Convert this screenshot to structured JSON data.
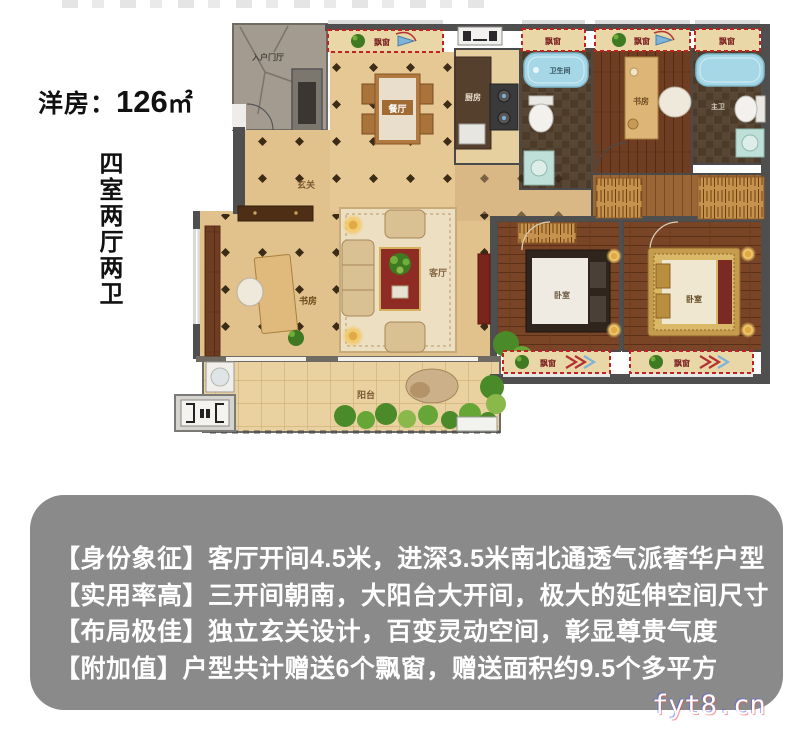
{
  "page": {
    "background": "#ffffff"
  },
  "header": {
    "title_prefix": "洋房：",
    "title_area": "126",
    "title_unit": "㎡",
    "vertical_label": "四室两厅两卫"
  },
  "floorplan": {
    "labels": {
      "entry_hall": "入户门厅",
      "foyer": "玄关",
      "dining": "餐厅",
      "kitchen": "厨房",
      "bath_main": "卫生间",
      "bath_master": "主卫",
      "study_top": "书房",
      "study_left": "书房",
      "living": "客厅",
      "bedroom_1": "卧室",
      "bedroom_2": "卧室",
      "balcony": "阳台",
      "bay_window": "飘窗"
    },
    "colors": {
      "wall": "#4f4f4f",
      "floor_beige": "#e2c28c",
      "wood_dark": "#7a4527",
      "bay_window_border": "#c32222",
      "bathtub_blue": "#a6d7e6",
      "stone_gray": "#a39b90"
    }
  },
  "features": {
    "panel_color": "#8a8a8a",
    "lines": [
      "【身份象征】客厅开间4.5米，进深3.5米南北通透气派奢华户型",
      "【实用率高】三开间朝南，大阳台大开间，极大的延伸空间尺寸",
      "【布局极佳】独立玄关设计，百变灵动空间，彰显尊贵气度",
      "【附加值】户型共计赠送6个飘窗，赠送面积约9.5个多平方"
    ]
  },
  "watermark": "fyt8.cn"
}
